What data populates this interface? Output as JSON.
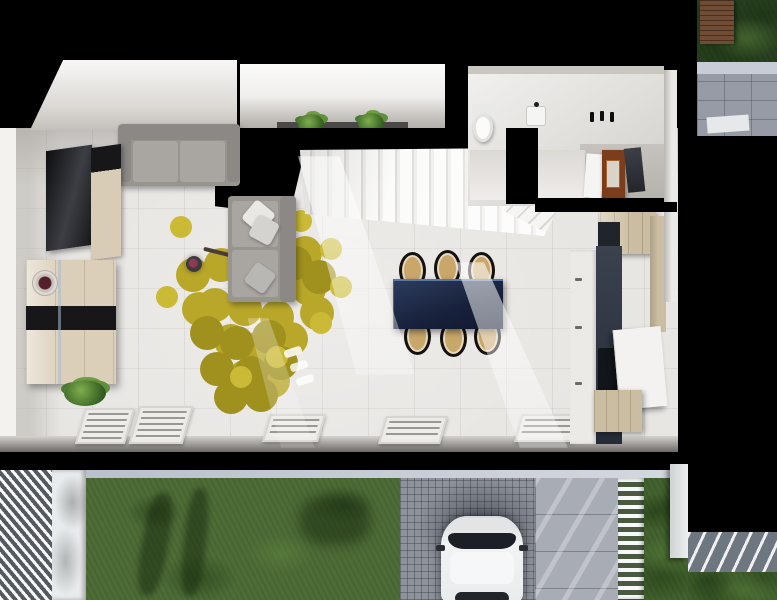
{
  "scene": {
    "description": "Top-down 3D dollhouse render of a ground floor apartment with garden, driveway and parked car",
    "view": "top-down-3d-render",
    "palette": {
      "background": "#000000",
      "floor": "#e8e6e3",
      "wall_cut": "#000000",
      "wall_face": "#f2f1ee",
      "sofa_grey": "#98958f",
      "pillow_white": "#e9e8e5",
      "rug_yellow": "#b7a41f",
      "rug_olive": "#9c8d15",
      "rug_light": "#c9b82c",
      "lamp_head_accent": "#8d3a55",
      "table_navy": "#1d2a47",
      "chair_frame": "#14110e",
      "chair_seat": "#c9a76b",
      "kitchen_wood": "#cbbda1",
      "kitchen_white": "#eceae7",
      "counter_dark": "#323a46",
      "cabinet_brown": "#7c3d1c",
      "door_dark": "#33363b",
      "toilet_white": "#fbfbfa",
      "plant_green": "#4f7a31",
      "sideboard_beige": "#dbcfba",
      "sideboard_stripe": "#17171a",
      "tv_screen": "#26272b",
      "grass": "#4d6c36",
      "grass_dark": "#42622e",
      "upper_grass": "#27401f",
      "deck_wood": "#6f4c33",
      "stone_wall": "#969ba5",
      "curb": "#c3c9d2",
      "cobblestone": "#8e939b",
      "pavement": "#a8adb5",
      "fence_white": "#f7f8f9",
      "car_body": "#eef0f1",
      "car_glass": "#1c2026",
      "pergola_grey": "#6e7680"
    },
    "interior": {
      "rooms": [
        "living-room",
        "dining-area",
        "kitchen",
        "staircase",
        "entry-alcove",
        "wc-entry-hall"
      ],
      "living_room": {
        "items": [
          "wall-tv",
          "media-panel",
          "sideboard",
          "two-seat-sofa",
          "chaise-sofa",
          "puzzle-rug",
          "arc-floor-lamp",
          "floor-plant"
        ]
      },
      "dining": {
        "table_color": "#1d2a47",
        "chair_count": 6
      },
      "kitchen": {
        "items": [
          "upper-wood-cabinet",
          "white-cabinet-column",
          "dark-countertop",
          "sink",
          "island-cabinet",
          "lower-wood-cabinet"
        ]
      },
      "staircase": {
        "step_count": 14,
        "shape": "straight-with-winders"
      },
      "entry_alcove": {
        "plant_count": 2
      },
      "wc": {
        "cabinet_color": "#7c3d1c",
        "items": [
          "toilet",
          "hand-basin",
          "coat-hooks",
          "white-door",
          "brown-wardrobe",
          "open-dark-door"
        ]
      },
      "radiator_grille_count": 5,
      "sunbeam_count": 3
    },
    "exterior": {
      "grass_color": "#4d6c36",
      "grass_dark_color": "#42622e",
      "upper_grass_color": "#27401f",
      "cobblestone_color": "#8e939b",
      "pavement_color": "#a8adb5",
      "items": [
        "louver-canopy",
        "lawn",
        "tree-shadows",
        "curb",
        "cobblestone-driveway",
        "white-car",
        "paved-path",
        "white-slat-fence",
        "side-wall",
        "black-cutout",
        "pergola-fragment",
        "wood-deck-fragment",
        "stone-wall-fragment"
      ]
    }
  }
}
